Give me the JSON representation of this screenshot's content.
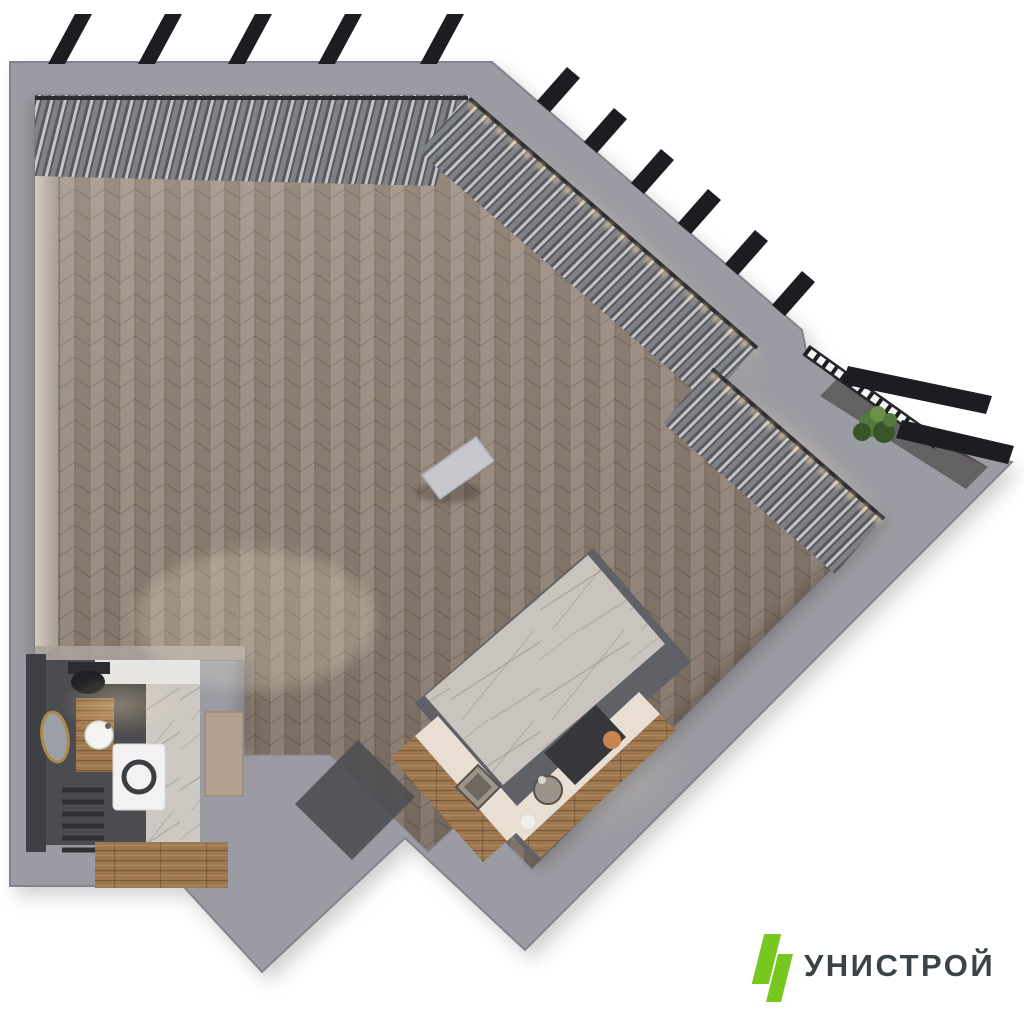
{
  "logo": {
    "text": "УНИСТРОЙ"
  },
  "colors": {
    "background": "#ffffff",
    "wall": "#9b9ca3",
    "wall_light": "#a9aab1",
    "wall_shadow": "#83848b",
    "inner_wall_lit": "#d8cfc6",
    "floor_base": "#8d7f73",
    "floor_light": "#a3948a",
    "floor_dark": "#7b6e64",
    "curtain_dark": "#55565c",
    "curtain_mid": "#7e8088",
    "curtain_light": "#d9dade",
    "rail_glow": "#ffdfa8",
    "rod": "#2c2c30",
    "fin": "#1c1d21",
    "bath_floor": "#4b4c50",
    "bath_wall_dark": "#3f4045",
    "marble_light": "#cdc9c2",
    "marble_vein": "#8f8d8a",
    "wood": "#a0784f",
    "wood_dark": "#7c5c3a",
    "counter_cream": "#e8dfd2",
    "counter_dark": "#5f6167",
    "island_marble": "#c7c2ba",
    "steel": "#9a948a",
    "hob": "#35373b",
    "door_tan": "#b3a08e",
    "mat": "#4e4f54",
    "plant": "#54793c",
    "plant_dark": "#3a5429",
    "gold": "#b08848",
    "white_goods": "#f2f2f2",
    "logo_green": "#76c81e",
    "logo_text": "#3b4349"
  }
}
